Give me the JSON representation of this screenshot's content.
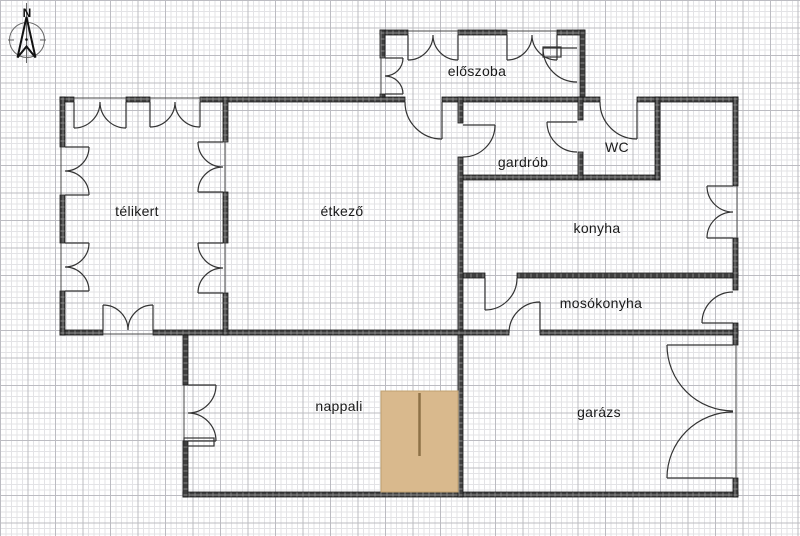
{
  "page": {
    "type": "architectural floor plan"
  },
  "compass": {
    "label": "N"
  },
  "rooms": [
    {
      "id": "eloszoba",
      "label": "előszoba"
    },
    {
      "id": "gardrob",
      "label": "gardrób"
    },
    {
      "id": "wc",
      "label": "WC"
    },
    {
      "id": "telikert",
      "label": "télikert"
    },
    {
      "id": "etkezo",
      "label": "étkező"
    },
    {
      "id": "konyha",
      "label": "konyha"
    },
    {
      "id": "mosokonyha",
      "label": "mosókonyha"
    },
    {
      "id": "nappali",
      "label": "nappali"
    },
    {
      "id": "garazs",
      "label": "garázs"
    }
  ],
  "colors": {
    "wall": "#3d3d3d",
    "line": "#333333",
    "grid_minor": "#e3e3e6",
    "grid_major": "#bcbcc2",
    "stairs_fill": "#d9b98d",
    "stairs_accent": "#8d7147",
    "background": "#ffffff"
  }
}
